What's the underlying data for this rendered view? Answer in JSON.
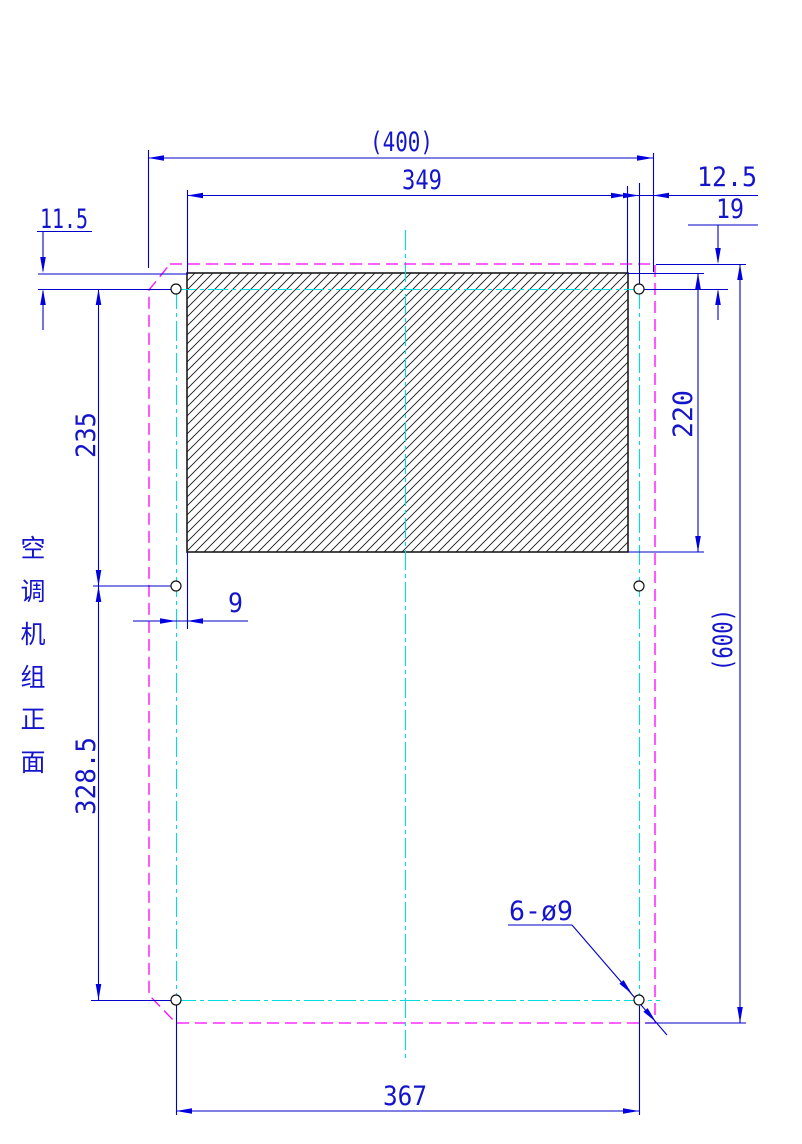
{
  "drawing_label": {
    "text": "空调机组正面",
    "chars": [
      "空",
      "调",
      "机",
      "组",
      "正",
      "面"
    ]
  },
  "dimensions": {
    "overall_width": "(400)",
    "opening_width": "349",
    "hole_to_right_edge": "12.5",
    "top_edge_to_hole": "19",
    "opening_top_to_hole": "11.5",
    "hole_row1_to_row2": "235",
    "opening_height": "220",
    "hole_to_opening_left": "9",
    "hole_row2_to_row3": "328.5",
    "overall_height": "(600)",
    "hole_callout": "6-ø9",
    "bottom_hole_span": "367"
  },
  "colors": {
    "dimension": "#0000C8",
    "arrow": "#0000E0",
    "text": "#1414CC",
    "outline": "#FF00FF",
    "centerline": "#00DFDF",
    "hatch": "#1A1A1A",
    "background": "#FFFFFF"
  }
}
